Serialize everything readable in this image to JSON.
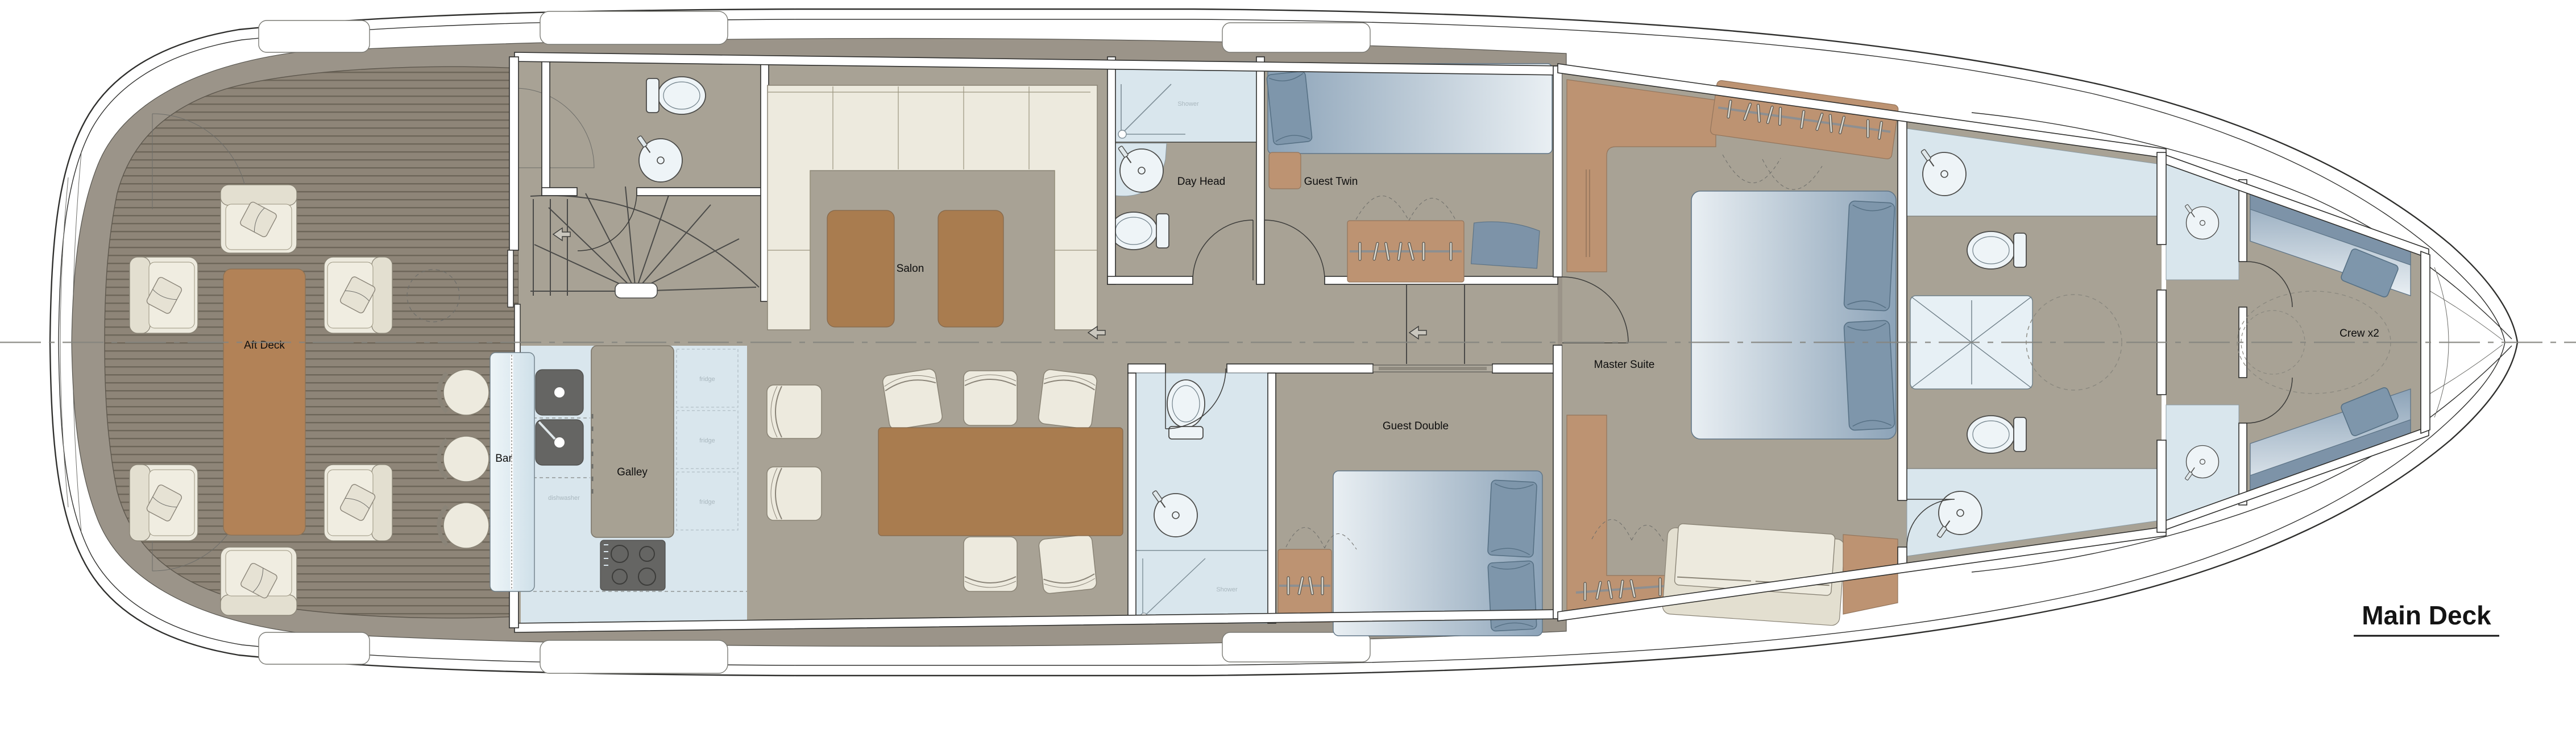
{
  "title": {
    "label": "Main Deck"
  },
  "rooms": {
    "aft_deck": "Aft Deck",
    "bar": "Bar",
    "galley": "Galley",
    "salon": "Salon",
    "day_head": "Day Head",
    "guest_twin": "Guest Twin",
    "guest_double": "Guest Double",
    "master_suite": "Master Suite",
    "crew": "Crew x2"
  },
  "fixtures": {
    "fridge": "fridge",
    "dishwasher": "dishwasher",
    "shower": "Shower"
  },
  "colors": {
    "deck_band": "#9b9489",
    "teak": "#8e8578",
    "interior_floor": "#a8a295",
    "wet_area": "#d9e6ed",
    "upholstery_cream": "#edeade",
    "wood_brown": "#b28257",
    "wardrobe_brown": "#bd9372",
    "bed_blue": "#8ca3b8",
    "pillow_blue": "#7e96ab",
    "outline": "#2f2f2d"
  }
}
